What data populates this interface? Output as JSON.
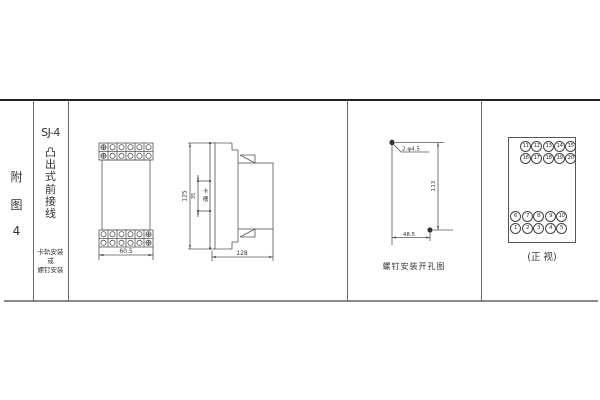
{
  "colors": {
    "bg": "#ffffff",
    "line": "#666666",
    "dark_line": "#222222",
    "text": "#333333"
  },
  "figure": {
    "index_chars": [
      "附",
      "图",
      "4"
    ],
    "model": "SJ-4",
    "type_chars": [
      "凸",
      "出",
      "式",
      "前",
      "接",
      "线"
    ],
    "mount_lines": [
      "卡轨安装",
      "或",
      "螺钉安装"
    ]
  },
  "front_view": {
    "width_dim": "60.5"
  },
  "side_view": {
    "height_dim": "125",
    "slot_dim": "35",
    "slot_chars": [
      "卡",
      "槽"
    ],
    "depth_dim": "128"
  },
  "drill_view": {
    "holes_label": "2-φ4.5",
    "height_dim": "113",
    "width_dim": "48.5",
    "caption": "螺钉安装开孔图"
  },
  "terminal_view": {
    "caption": "(正 视)",
    "rows": {
      "t1": [
        "11",
        "12",
        "13",
        "14",
        "15"
      ],
      "t2": [
        "16",
        "17",
        "18",
        "19",
        "20"
      ],
      "b1": [
        "6",
        "7",
        "8",
        "9",
        "10"
      ],
      "b2": [
        "1",
        "2",
        "3",
        "4",
        "5"
      ]
    }
  }
}
